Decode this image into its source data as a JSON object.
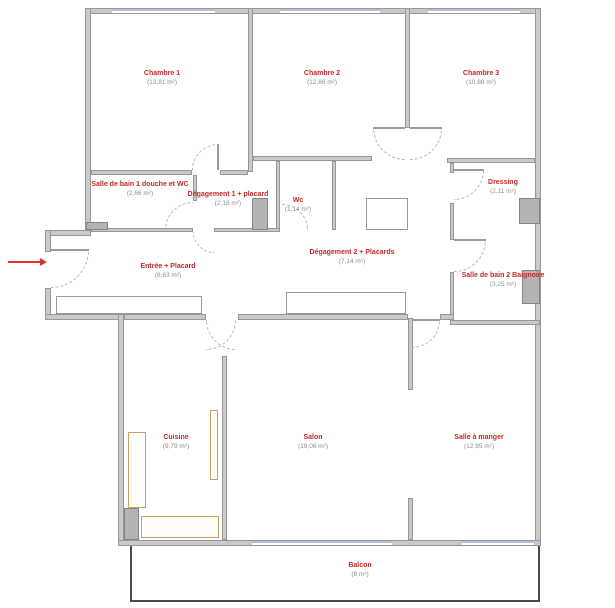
{
  "plan": {
    "type": "apartment-floor-plan",
    "language": "fr"
  },
  "rooms": [
    {
      "name": "Chambre 1",
      "area": "(13,81 m²)"
    },
    {
      "name": "Chambre 2",
      "area": "(12,86 m²)"
    },
    {
      "name": "Chambre 3",
      "area": "(10,88 m²)"
    },
    {
      "name": "Salle de bain 1 douche et WC",
      "area": "(2,66 m²)"
    },
    {
      "name": "Dégagement 1 + placard",
      "area": "(2,16 m²)"
    },
    {
      "name": "Wc",
      "area": "(1,14 m²)"
    },
    {
      "name": "Dressing",
      "area": "(2,11 m²)"
    },
    {
      "name": "Entrée + Placard",
      "area": "(8,63 m²)"
    },
    {
      "name": "Dégagement 2 + Placards",
      "area": "(7,14 m²)"
    },
    {
      "name": "Salle de bain 2 Baignoire",
      "area": "(3,25 m²)"
    },
    {
      "name": "Cuisine",
      "area": "(9,79 m²)"
    },
    {
      "name": "Salon",
      "area": "(19,06 m²)"
    },
    {
      "name": "Salle à manger",
      "area": "(12,95 m²)"
    },
    {
      "name": "Balcon",
      "area": "(9 m²)"
    }
  ],
  "colors": {
    "room_name_text": "#c62828",
    "room_area_text": "#8d8d8d",
    "wall_fill": "#c9c9c9",
    "wall_stroke": "#979797",
    "window": "#b4bede",
    "kitchen_furniture": "#c9a063",
    "balcony_outline": "#4a4a4a",
    "entrance_arrow": "#e03030"
  }
}
